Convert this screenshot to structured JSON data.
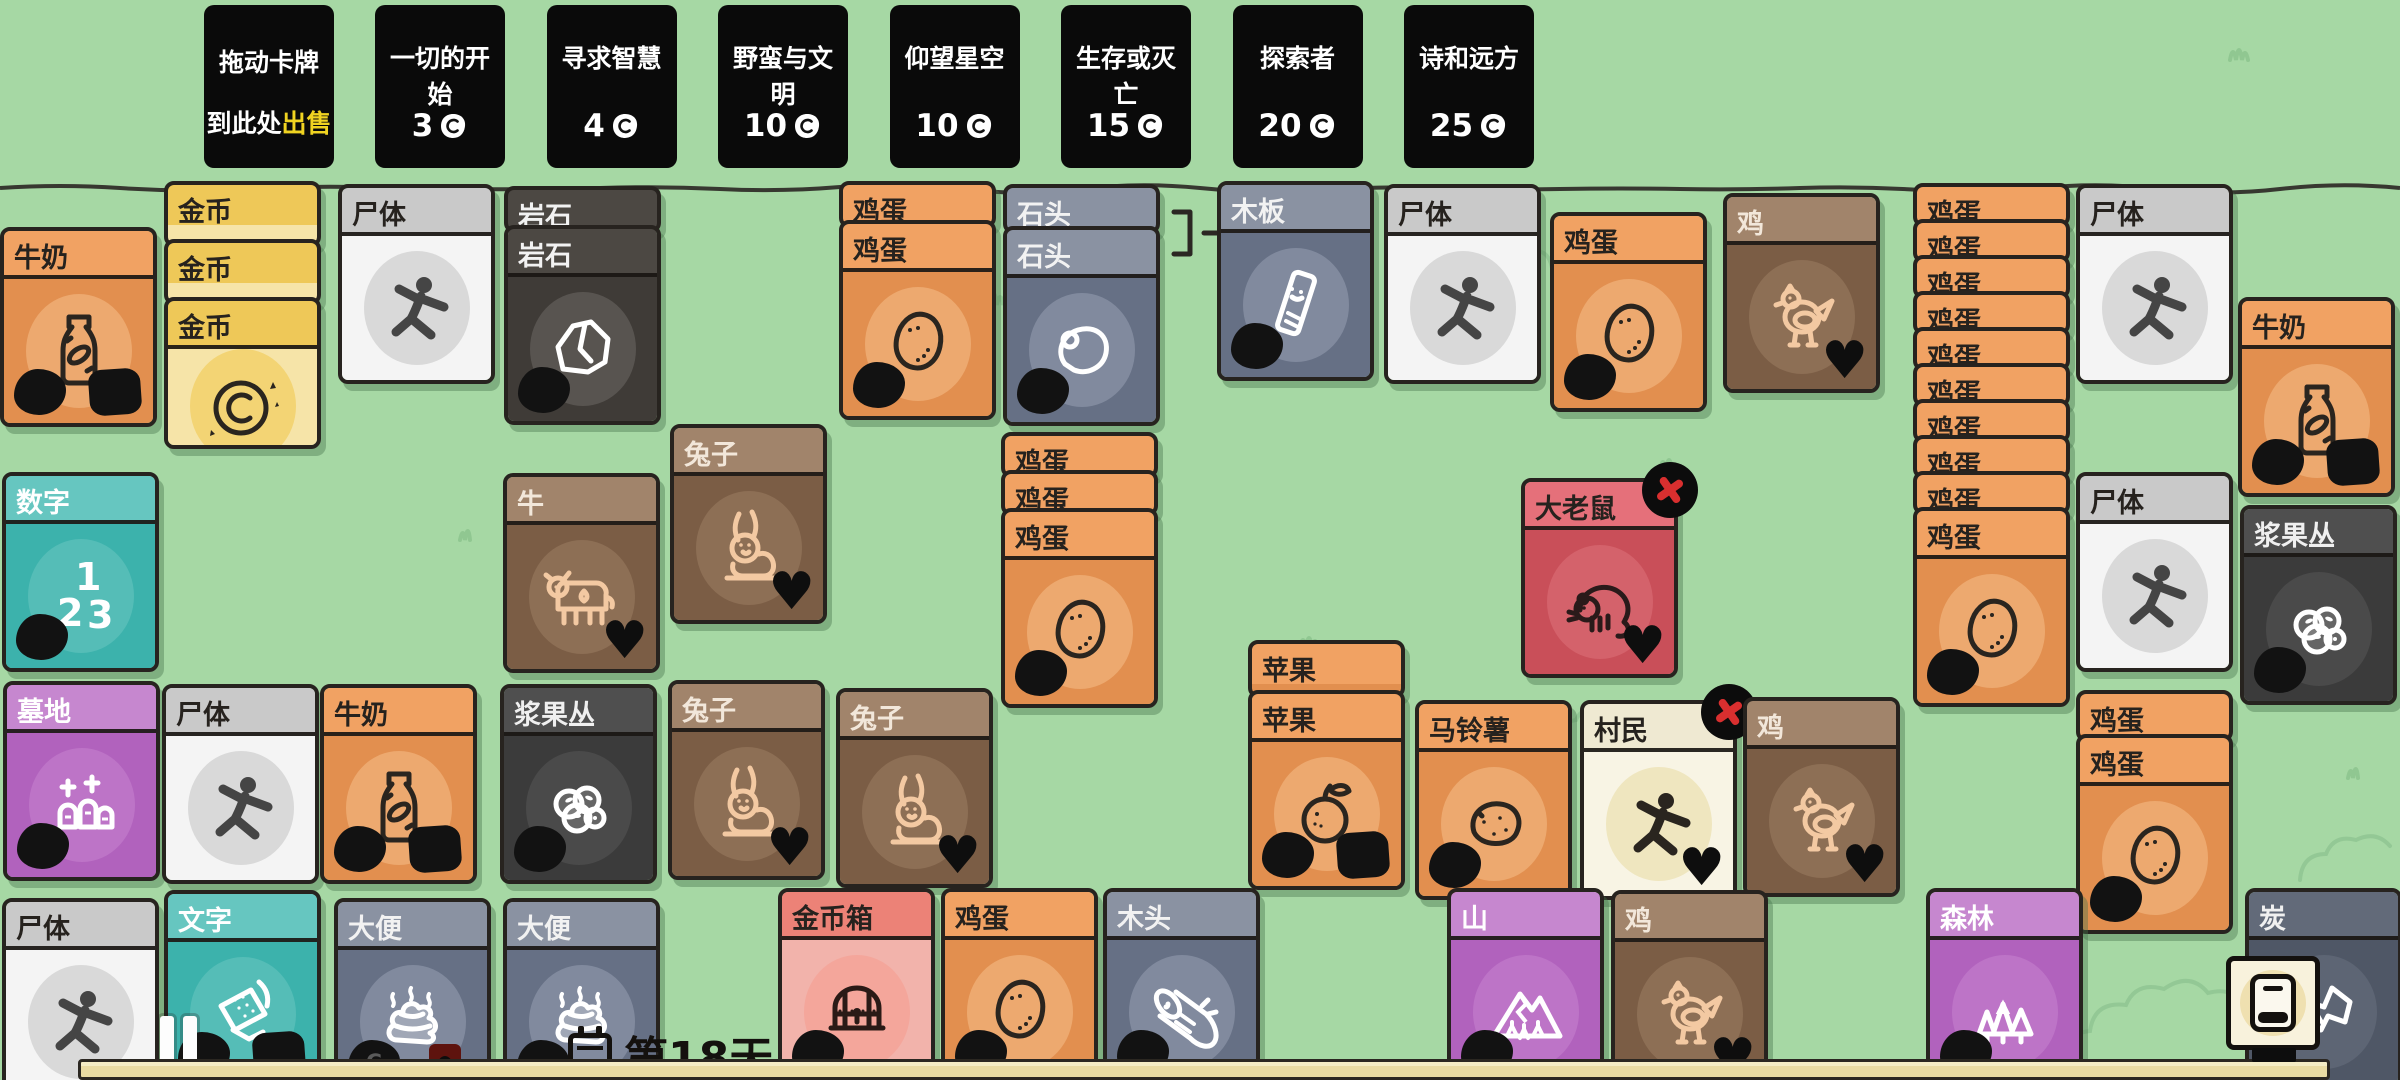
{
  "sell_area": {
    "line1": "拖动卡牌",
    "line2_prefix": "到此处",
    "line2_highlight": "出售"
  },
  "packs": [
    {
      "name": "一切的开始",
      "price": "3"
    },
    {
      "name": "寻求智慧",
      "price": "4"
    },
    {
      "name": "野蛮与文明",
      "price": "10"
    },
    {
      "name": "仰望星空",
      "price": "10"
    },
    {
      "name": "生存或灭亡",
      "price": "15"
    },
    {
      "name": "探索者",
      "price": "20"
    },
    {
      "name": "诗和远方",
      "price": "25"
    }
  ],
  "hud": {
    "day_label": "第18天",
    "day_progress_percent": 97,
    "pause_icon": "pause-icon",
    "deck_icon": "deck-book-icon",
    "calendar_icon": "calendar-icon"
  },
  "colors": {
    "background": "#a6d8a4",
    "card_border": "#27231f",
    "pack_bg": "#0a0a0a",
    "sell_highlight": "#f0d321",
    "progress_fill": "#e9dba2",
    "close_x": "#d92f2f"
  },
  "palette": {
    "orange": {
      "header": "#f1a263",
      "body": "#e28f4f",
      "text": "#26221e",
      "stroke": "#2a251f",
      "icon_bg": "#eda96f"
    },
    "coin": {
      "header": "#eec858",
      "body": "#f6e4a8",
      "text": "#26221e",
      "stroke": "#2a251f",
      "icon_bg": "#f3d474"
    },
    "white": {
      "header": "#c9c9c9",
      "body": "#f4f4f4",
      "text": "#26221e",
      "stroke": "#454545",
      "icon_bg": "#d9d9d9"
    },
    "darkrock": {
      "header": "#4c4843",
      "body": "#3f3b37",
      "text": "#f2f2f2",
      "stroke": "#ffffff",
      "icon_bg": "#585450"
    },
    "bluegray": {
      "header": "#8a92a2",
      "body": "#667085",
      "text": "#f2f2f2",
      "stroke": "#ffffff",
      "icon_bg": "#818a9e"
    },
    "charcoal": {
      "header": "#626a79",
      "body": "#4f5766",
      "text": "#f0f0f0",
      "stroke": "#ffffff",
      "icon_bg": "#5d6574"
    },
    "brown": {
      "header": "#a1846b",
      "body": "#7b5d45",
      "text": "#f2e7da",
      "stroke": "#f3c9a2",
      "icon_bg": "#8d6f55"
    },
    "red": {
      "header": "#e5707a",
      "body": "#c94f59",
      "text": "#26221e",
      "stroke": "#2a1a1a",
      "icon_bg": "#d4626b"
    },
    "cream": {
      "header": "#efe9d2",
      "body": "#f8f4e4",
      "text": "#26221e",
      "stroke": "#2a251f",
      "icon_bg": "#efe6bf"
    },
    "teal": {
      "header": "#66c6c0",
      "body": "#3cb2ac",
      "text": "#ffffff",
      "stroke": "#ffffff",
      "icon_bg": "#55bdb7"
    },
    "purple": {
      "header": "#c687cf",
      "body": "#b162bd",
      "text": "#ffffff",
      "stroke": "#ffffff",
      "icon_bg": "#bd74c7"
    },
    "darkberry": {
      "header": "#4f4f4f",
      "body": "#3b3b3b",
      "text": "#f0f0f0",
      "stroke": "#ffffff",
      "icon_bg": "#4a4a4a"
    },
    "salmon": {
      "header": "#ec8277",
      "body": "#f2b3ab",
      "text": "#26221e",
      "stroke": "#2a1a16",
      "icon_bg": "#f4a69b"
    }
  },
  "cards": [
    {
      "name": "milk-1",
      "label": "牛奶",
      "type": "orange",
      "icon": "milk-bottle-icon",
      "x": 0,
      "y": 227,
      "blobs": 2
    },
    {
      "name": "coin-stack",
      "label": "金币",
      "type": "coin",
      "icon": "coin-icon",
      "x": 164,
      "y": 181,
      "stack": 3,
      "slice": 66,
      "top_h": 152
    },
    {
      "name": "corpse-1",
      "label": "尸体",
      "type": "white",
      "icon": "corpse-icon",
      "x": 338,
      "y": 184
    },
    {
      "name": "rock-stack",
      "label": "岩石",
      "type": "darkrock",
      "icon": "rock-icon",
      "x": 504,
      "y": 186,
      "stack": 2,
      "slice": 47,
      "blobs": 1
    },
    {
      "name": "rabbit-1",
      "label": "兔子",
      "type": "brown",
      "icon": "rabbit-icon",
      "x": 670,
      "y": 424,
      "heart": true
    },
    {
      "name": "egg-stack-a",
      "label": "鸡蛋",
      "type": "orange",
      "icon": "egg-icon",
      "x": 839,
      "y": 181,
      "stack": 2,
      "slice": 47,
      "blobs": 1
    },
    {
      "name": "stone-stack",
      "label": "石头",
      "type": "bluegray",
      "icon": "stone-icon",
      "x": 1003,
      "y": 184,
      "stack": 2,
      "slice": 50,
      "blobs": 1
    },
    {
      "name": "plank",
      "label": "木板",
      "type": "bluegray",
      "icon": "plank-icon",
      "x": 1217,
      "y": 181,
      "blobs": 1
    },
    {
      "name": "corpse-2",
      "label": "尸体",
      "type": "white",
      "icon": "corpse-icon",
      "x": 1384,
      "y": 184
    },
    {
      "name": "egg-1",
      "label": "鸡蛋",
      "type": "orange",
      "icon": "egg-icon",
      "x": 1550,
      "y": 212,
      "blobs": 1
    },
    {
      "name": "chicken-1",
      "label": "鸡",
      "type": "brown",
      "icon": "chicken-icon",
      "x": 1723,
      "y": 193,
      "heart": true
    },
    {
      "name": "egg-stack-big",
      "label": "鸡蛋",
      "type": "orange",
      "icon": "egg-icon",
      "x": 1913,
      "y": 183,
      "stack": 10,
      "slice": 44,
      "blobs": 1
    },
    {
      "name": "corpse-3",
      "label": "尸体",
      "type": "white",
      "icon": "corpse-icon",
      "x": 2076,
      "y": 184
    },
    {
      "name": "milk-2",
      "label": "牛奶",
      "type": "orange",
      "icon": "milk-bottle-icon",
      "x": 2238,
      "y": 297,
      "blobs": 2
    },
    {
      "name": "numbers",
      "label": "数字",
      "type": "teal",
      "icon": "numbers-icon",
      "x": 2,
      "y": 472,
      "blobs": 1
    },
    {
      "name": "cow",
      "label": "牛",
      "type": "brown",
      "icon": "cow-icon",
      "x": 503,
      "y": 473,
      "heart": true
    },
    {
      "name": "egg-stack-b",
      "label": "鸡蛋",
      "type": "orange",
      "icon": "egg-icon",
      "x": 1001,
      "y": 432,
      "stack": 3,
      "slice": 46,
      "blobs": 1
    },
    {
      "name": "big-rat",
      "label": "大老鼠",
      "type": "red",
      "icon": "rat-icon",
      "x": 1521,
      "y": 478,
      "heart": true,
      "close": true
    },
    {
      "name": "corpse-4",
      "label": "尸体",
      "type": "white",
      "icon": "corpse-icon",
      "x": 2076,
      "y": 472
    },
    {
      "name": "berry-bush-1",
      "label": "浆果丛",
      "type": "darkberry",
      "icon": "berries-icon",
      "x": 2240,
      "y": 505,
      "blobs": 1
    },
    {
      "name": "graveyard",
      "label": "墓地",
      "type": "purple",
      "icon": "graves-icon",
      "x": 3,
      "y": 681,
      "blobs": 1
    },
    {
      "name": "corpse-5",
      "label": "尸体",
      "type": "white",
      "icon": "corpse-icon",
      "x": 162,
      "y": 684
    },
    {
      "name": "milk-3",
      "label": "牛奶",
      "type": "orange",
      "icon": "milk-bottle-icon",
      "x": 320,
      "y": 684,
      "blobs": 2
    },
    {
      "name": "berry-bush-2",
      "label": "浆果丛",
      "type": "darkberry",
      "icon": "berries-icon",
      "x": 500,
      "y": 684,
      "blobs": 1
    },
    {
      "name": "rabbit-2",
      "label": "兔子",
      "type": "brown",
      "icon": "rabbit-icon",
      "x": 668,
      "y": 680,
      "heart": true
    },
    {
      "name": "rabbit-3",
      "label": "兔子",
      "type": "brown",
      "icon": "rabbit-icon",
      "x": 836,
      "y": 688,
      "heart": true
    },
    {
      "name": "apple-stack",
      "label": "苹果",
      "type": "orange",
      "icon": "apple-icon",
      "x": 1248,
      "y": 640,
      "stack": 2,
      "slice": 58,
      "blobs": 2
    },
    {
      "name": "potato",
      "label": "马铃薯",
      "type": "orange",
      "icon": "potato-icon",
      "x": 1415,
      "y": 700,
      "blobs": 1
    },
    {
      "name": "villager",
      "label": "村民",
      "type": "cream",
      "icon": "villager-icon",
      "x": 1580,
      "y": 700,
      "heart": true,
      "close": true
    },
    {
      "name": "chicken-2",
      "label": "鸡",
      "type": "brown",
      "icon": "chicken-icon",
      "x": 1743,
      "y": 697,
      "heart": true
    },
    {
      "name": "egg-stack-c",
      "label": "鸡蛋",
      "type": "orange",
      "icon": "egg-icon",
      "x": 2076,
      "y": 690,
      "stack": 2,
      "slice": 52,
      "blobs": 1
    },
    {
      "name": "corpse-6",
      "label": "尸体",
      "type": "white",
      "icon": "corpse-icon",
      "x": 2,
      "y": 898
    },
    {
      "name": "script-card",
      "label": "文字",
      "type": "teal",
      "icon": "script-icon",
      "x": 164,
      "y": 890,
      "blobs": 2
    },
    {
      "name": "poop-1",
      "label": "大便",
      "type": "bluegray",
      "icon": "poop-icon",
      "x": 334,
      "y": 898,
      "blobs": 1,
      "coin_c": true,
      "badge_red": true
    },
    {
      "name": "poop-2",
      "label": "大便",
      "type": "bluegray",
      "icon": "poop-icon",
      "x": 503,
      "y": 898,
      "blobs": 1
    },
    {
      "name": "coin-chest",
      "label": "金币箱",
      "type": "salmon",
      "icon": "chest-icon",
      "x": 778,
      "y": 888,
      "blobs": 1
    },
    {
      "name": "egg-2",
      "label": "鸡蛋",
      "type": "orange",
      "icon": "egg-icon",
      "x": 941,
      "y": 888,
      "blobs": 1
    },
    {
      "name": "wood",
      "label": "木头",
      "type": "bluegray",
      "icon": "log-icon",
      "x": 1103,
      "y": 888,
      "blobs": 1
    },
    {
      "name": "mountain",
      "label": "山",
      "type": "purple",
      "icon": "mountain-icon",
      "x": 1447,
      "y": 888,
      "blobs": 1
    },
    {
      "name": "chicken-3",
      "label": "鸡",
      "type": "brown",
      "icon": "chicken-icon",
      "x": 1611,
      "y": 890,
      "heart": true
    },
    {
      "name": "forest",
      "label": "森林",
      "type": "purple",
      "icon": "forest-icon",
      "x": 1926,
      "y": 888,
      "blobs": 1
    },
    {
      "name": "charcoal",
      "label": "炭",
      "type": "charcoal",
      "icon": "charcoal-icon",
      "x": 2245,
      "y": 888
    }
  ]
}
